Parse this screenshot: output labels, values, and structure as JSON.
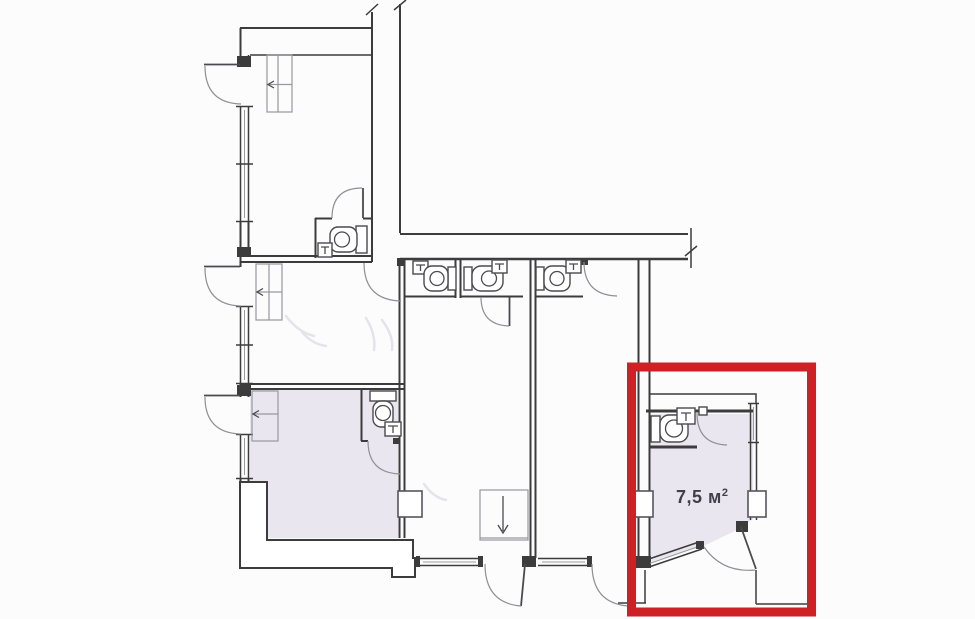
{
  "plan": {
    "highlighted_room": {
      "area_value": "7,5 м",
      "area_superscript": "2",
      "area_full": "7,5 м²"
    },
    "colors": {
      "highlight_red": "#cd2126",
      "room_fill": "#eae6ef",
      "line": "#3c3c3c",
      "background": "#fcfcfc",
      "label": "#413f4c"
    },
    "icons": [
      "toilet-icon",
      "sink-icon",
      "door-swing-icon",
      "window-icon",
      "wardrobe-icon",
      "arrow-down-icon",
      "arrow-left-icon",
      "wall-break-icon"
    ]
  }
}
